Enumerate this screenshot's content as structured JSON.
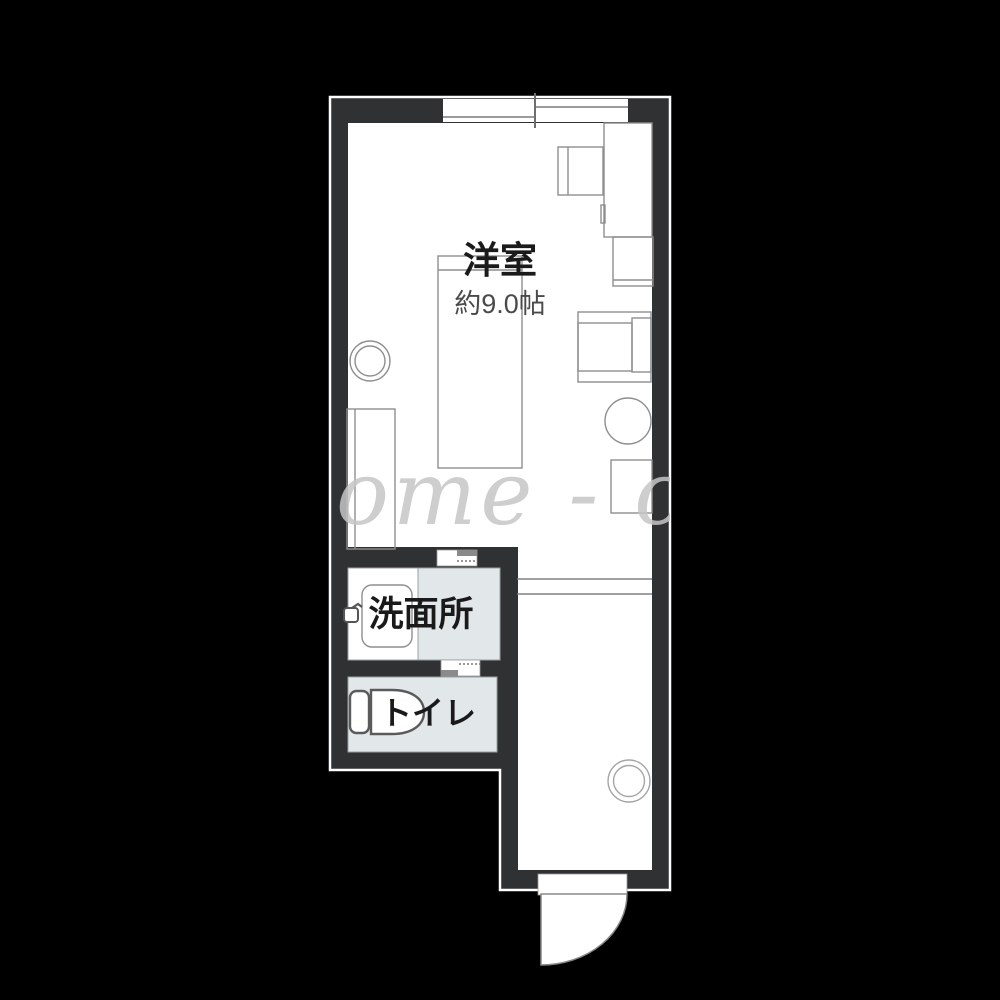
{
  "floor_plan": {
    "rooms": {
      "western_room": {
        "name": "洋室",
        "size": "約9.0帖"
      },
      "washroom": {
        "name": "洗面所"
      },
      "toilet": {
        "name": "トイレ"
      }
    },
    "watermark": "ome - cl",
    "colors": {
      "background": "#000000",
      "wall": "#2f3133",
      "floor": "#ffffff",
      "wet_floor": "#e2e8ea",
      "furniture_outline": "#8e8e8e",
      "fixture_outline": "#5a5a5a",
      "label_text": "#1a1a1a",
      "size_text": "#4a4a4a",
      "watermark_color": "#c6c6c6"
    }
  }
}
